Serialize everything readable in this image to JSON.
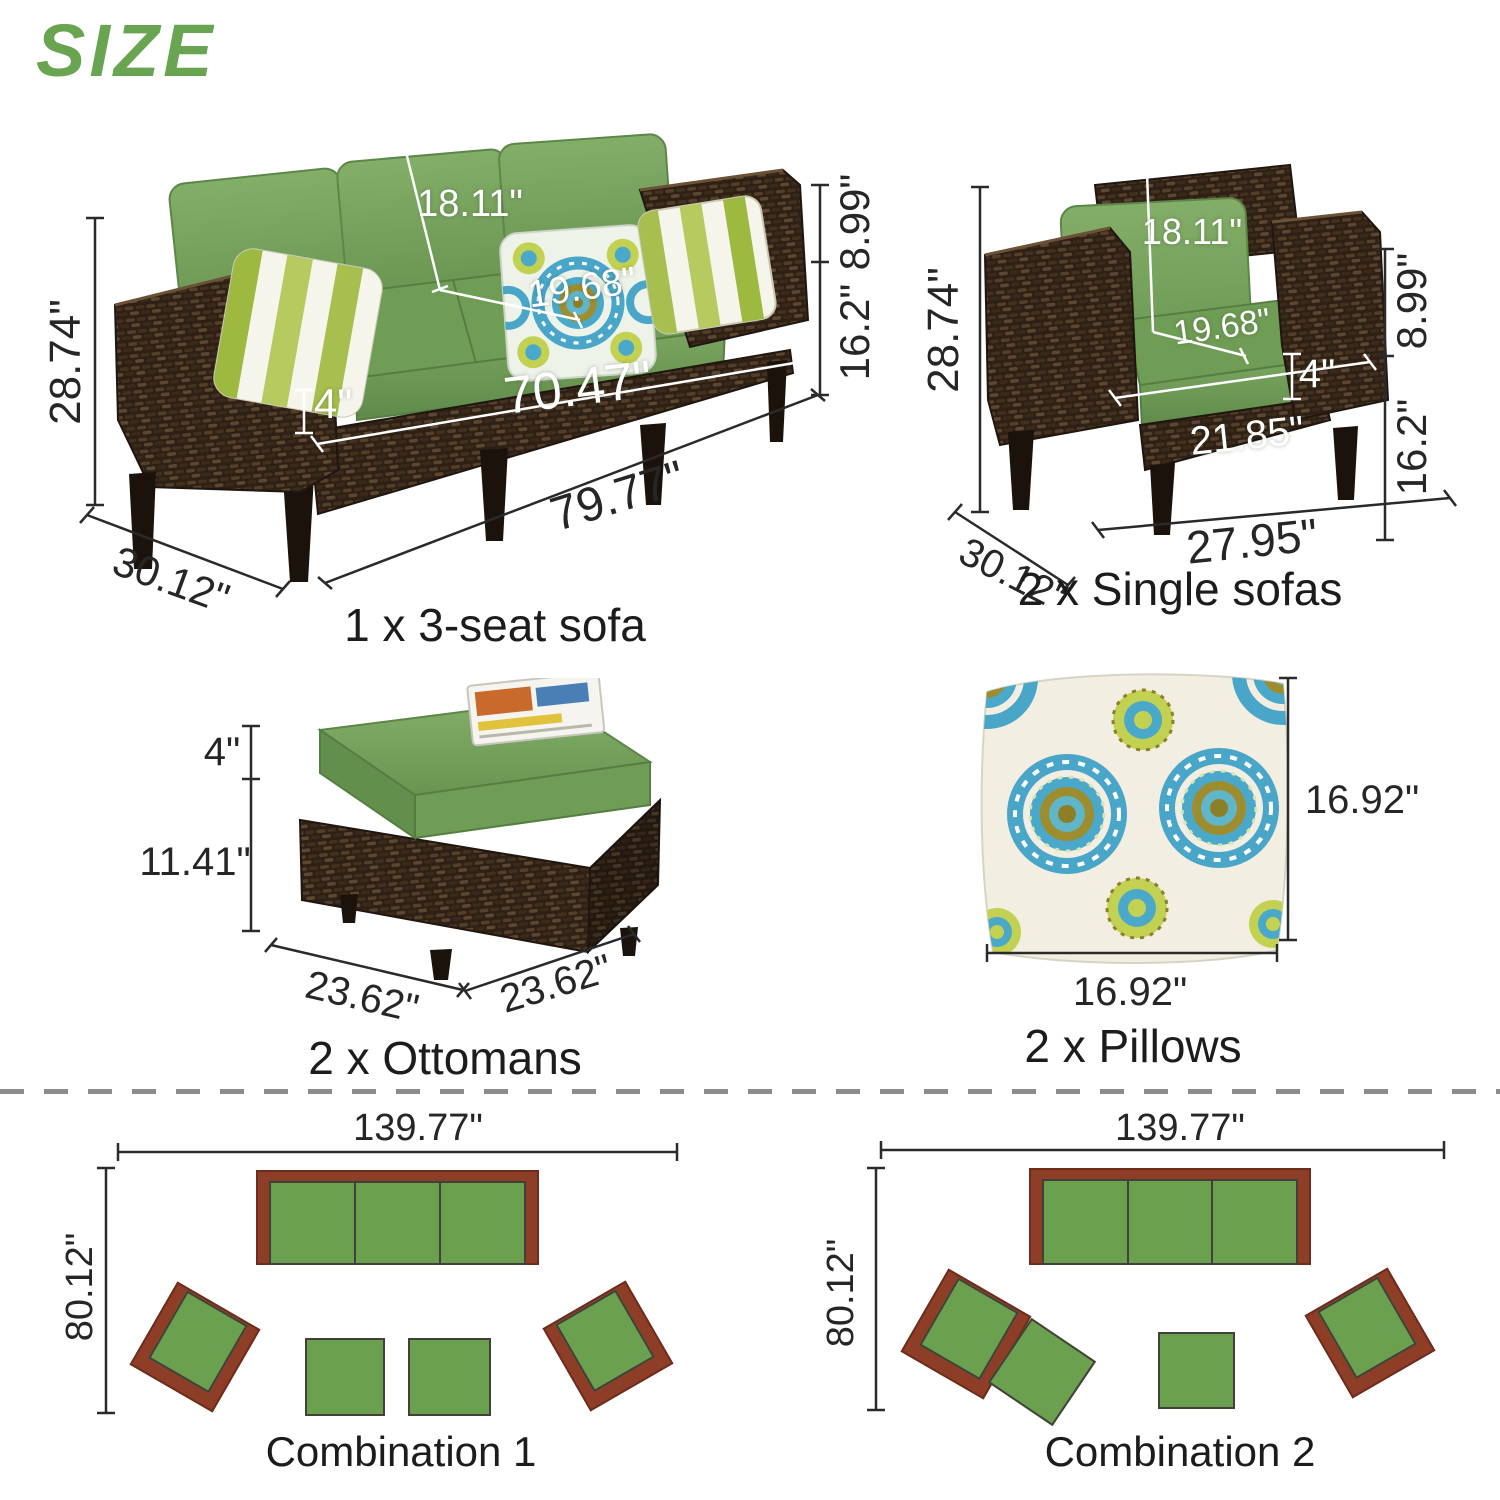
{
  "title": "SIZE",
  "colors": {
    "accent": "#69a551",
    "cushion_green": "#6f9d55",
    "wicker_brown": "#2e2015",
    "diagram_green": "#6ba04f",
    "diagram_brown": "#8e3d27",
    "dim_text": "#262626"
  },
  "sofa3": {
    "caption": "1 x 3-seat sofa",
    "height": "28.74\"",
    "back_cushion_height": "18.11\"",
    "seat_depth": "19.68\"",
    "cushion_thickness": "4\"",
    "seat_width": "70.47\"",
    "total_width": "79.77\"",
    "depth": "30.12\"",
    "arm_to_seat_height": "8.99\"",
    "seat_height": "16.2\""
  },
  "single_sofa": {
    "caption": "2 x Single sofas",
    "height": "28.74\"",
    "back_cushion_height": "18.11\"",
    "seat_depth": "19.68\"",
    "cushion_thickness": "4\"",
    "seat_width": "21.85\"",
    "total_width": "27.95\"",
    "depth": "30.12\"",
    "arm_to_seat_height": "8.99\"",
    "seat_height": "16.2\""
  },
  "ottoman": {
    "caption": "2 x Ottomans",
    "cushion_thickness": "4\"",
    "base_height": "11.41\"",
    "width": "23.62\"",
    "depth": "23.62\""
  },
  "pillow": {
    "caption": "2 x Pillows",
    "height": "16.92\"",
    "width": "16.92\""
  },
  "combination1": {
    "caption": "Combination 1",
    "width": "139.77\"",
    "depth": "80.12\""
  },
  "combination2": {
    "caption": "Combination 2",
    "width": "139.77\"",
    "depth": "80.12\""
  }
}
